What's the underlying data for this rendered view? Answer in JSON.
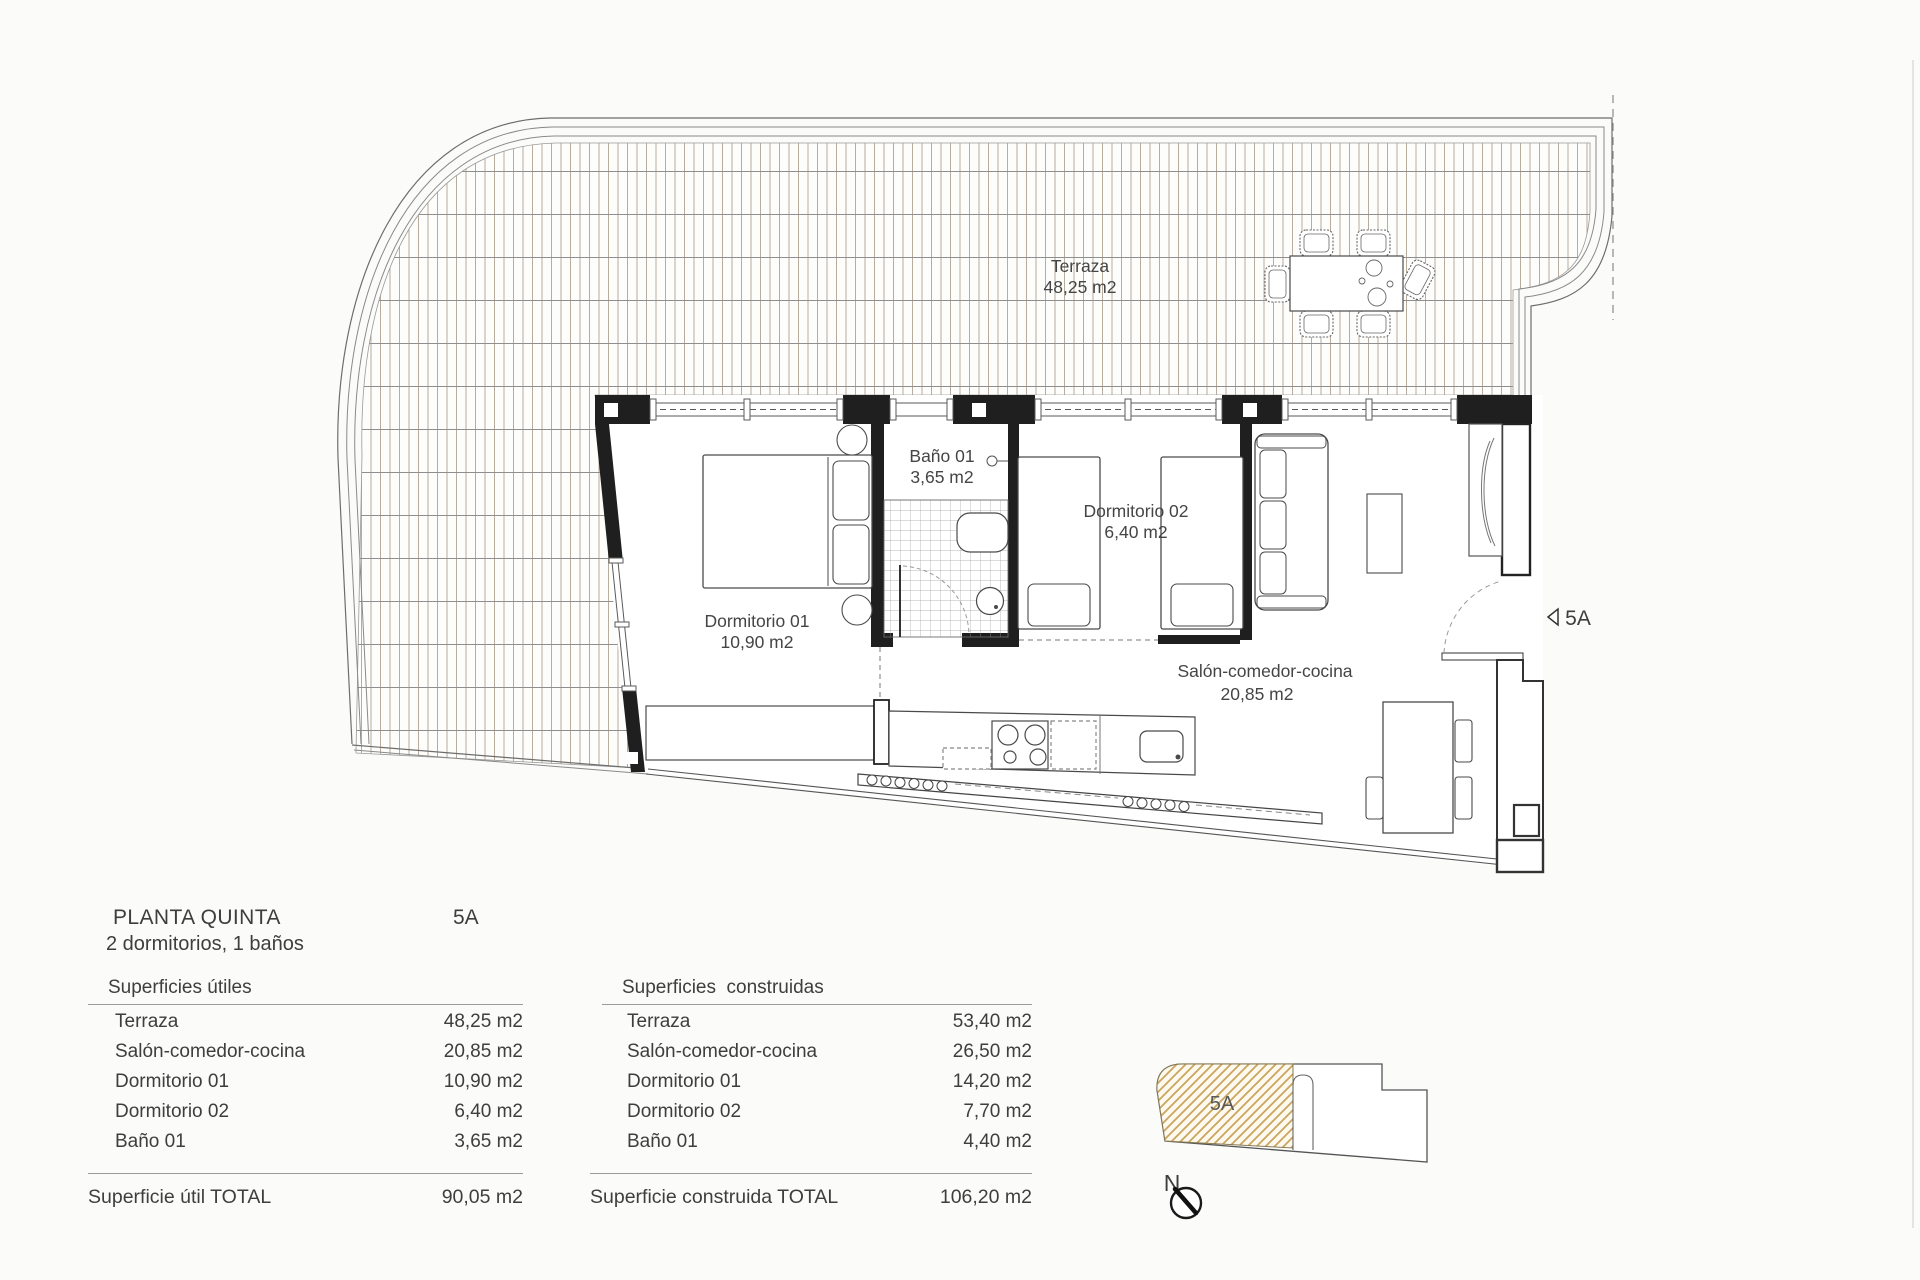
{
  "plan": {
    "terrace": {
      "name": "Terraza",
      "area": "48,25 m2"
    },
    "bathroom": {
      "name": "Baño 01",
      "area": "3,65 m2"
    },
    "bedroom1": {
      "name": "Dormitorio 01",
      "area": "10,90 m2"
    },
    "bedroom2": {
      "name": "Dormitorio 02",
      "area": "6,40 m2"
    },
    "living": {
      "name": "Salón-comedor-cocina",
      "area": "20,85 m2"
    },
    "entrance": {
      "label": "5A"
    }
  },
  "info": {
    "title": "PLANTA QUINTA",
    "unit": "5A",
    "subtitle": "2 dormitorios, 1 baños"
  },
  "tables": {
    "useful": {
      "header": "Superficies útiles",
      "rows": [
        [
          "Terraza",
          "48,25 m2"
        ],
        [
          "Salón-comedor-cocina",
          "20,85 m2"
        ],
        [
          "Dormitorio 01",
          "10,90 m2"
        ],
        [
          "Dormitorio 02",
          "6,40 m2"
        ],
        [
          "Baño 01",
          "3,65 m2"
        ]
      ],
      "total_label": "Superficie útil TOTAL",
      "total_value": "90,05 m2"
    },
    "built": {
      "header": "Superficies  construidas",
      "rows": [
        [
          "Terraza",
          "53,40 m2"
        ],
        [
          "Salón-comedor-cocina",
          "26,50 m2"
        ],
        [
          "Dormitorio 01",
          "14,20 m2"
        ],
        [
          "Dormitorio 02",
          "7,70 m2"
        ],
        [
          "Baño 01",
          "4,40 m2"
        ]
      ],
      "total_label": "Superficie construida TOTAL",
      "total_value": "106,20 m2"
    }
  },
  "keyplan": {
    "unit_label": "5A",
    "north_label": "N",
    "hatch_color": "#c9a55e"
  },
  "colors": {
    "wall": "#1f1f1f",
    "line": "#4a4a4a",
    "deck_line": "#b4a692",
    "text": "#3e3e3e"
  }
}
